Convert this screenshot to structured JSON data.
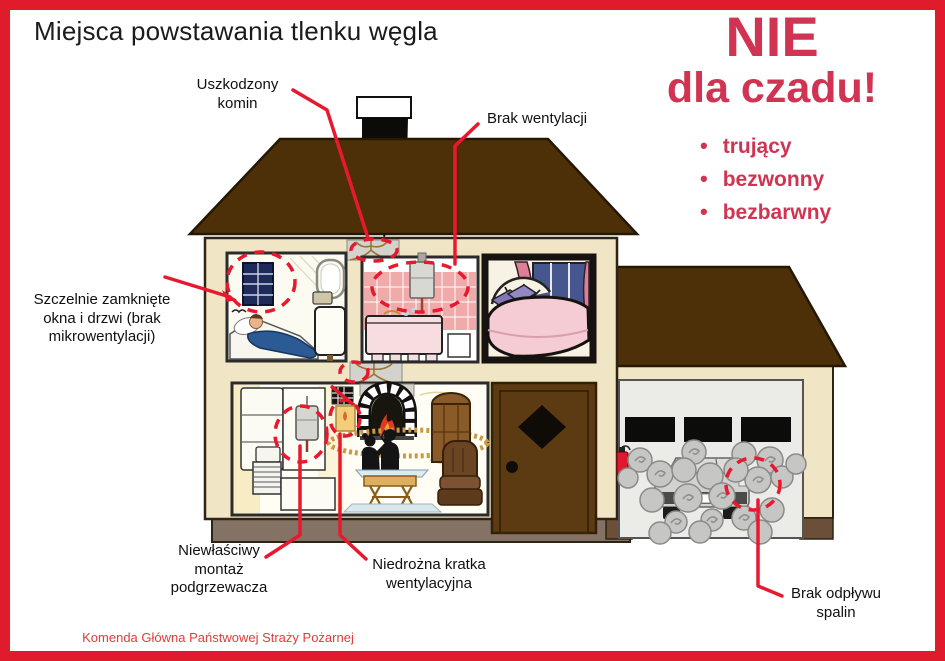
{
  "title": "Miejsca powstawania tlenku węgla",
  "slogan": {
    "line1": "NIE",
    "line2": "dla czadu!",
    "bullets": [
      "trujący",
      "bezwonny",
      "bezbarwny"
    ]
  },
  "callouts": {
    "chimney": "Uszkodzony\nkomin",
    "ventilation": "Brak wentylacji",
    "windows": "Szczelnie zamknięte\nokna i drzwi (brak\nmikrowentylacji)",
    "heater": "Niewłaściwy\nmontaż\npodgrzewacza",
    "grille": "Niedrożna kratka\nwentylacyjna",
    "exhaust": "Brak odpływu\nspalin"
  },
  "footer": {
    "line1": "Komenda Główna Państwowej Straży Pożarnej",
    "line2": "Wydział Informacji i Promocji"
  },
  "colors": {
    "frame_red": "#e01b2c",
    "slogan_red": "#d13453",
    "pointer_red": "#e8192e",
    "roof_brown": "#4e3008",
    "wall_cream": "#f0e5c4",
    "tile_pink": "#f0aaaa"
  }
}
